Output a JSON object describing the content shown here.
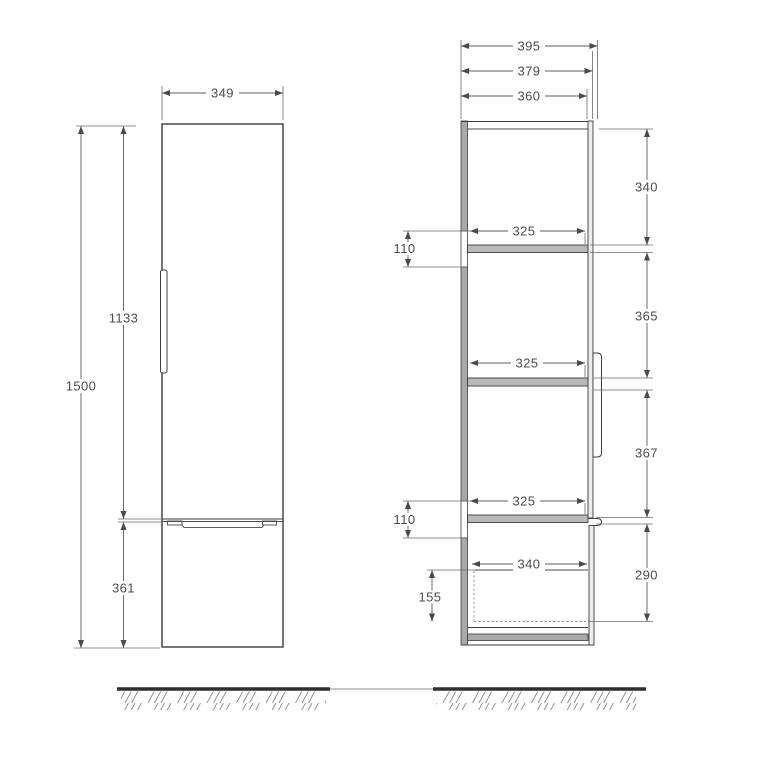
{
  "colors": {
    "background": "#ffffff",
    "line": "#3c3c3c",
    "dimension_line": "#5c5c5c",
    "label_text": "#4c4c4c",
    "panel_grey": "#a9a9a9",
    "shelf_grey": "#b9b9b9"
  },
  "front_view": {
    "width": "349",
    "height": "1500",
    "upper_section_height": "1133",
    "drawer_front_height": "361"
  },
  "side_view": {
    "depth_overall": "395",
    "depth_with_door": "379",
    "depth_internal": "360",
    "top_compartment_height": "340",
    "middle_compartment_height": "365",
    "lower_compartment_height": "367",
    "bottom_compartment_height": "290",
    "shelf1_depth": "325",
    "shelf2_depth": "325",
    "shelf3_depth": "325",
    "mount_rail_upper": "110",
    "mount_rail_lower": "110",
    "drawer_internal_depth": "340",
    "drawer_internal_height": "155"
  }
}
